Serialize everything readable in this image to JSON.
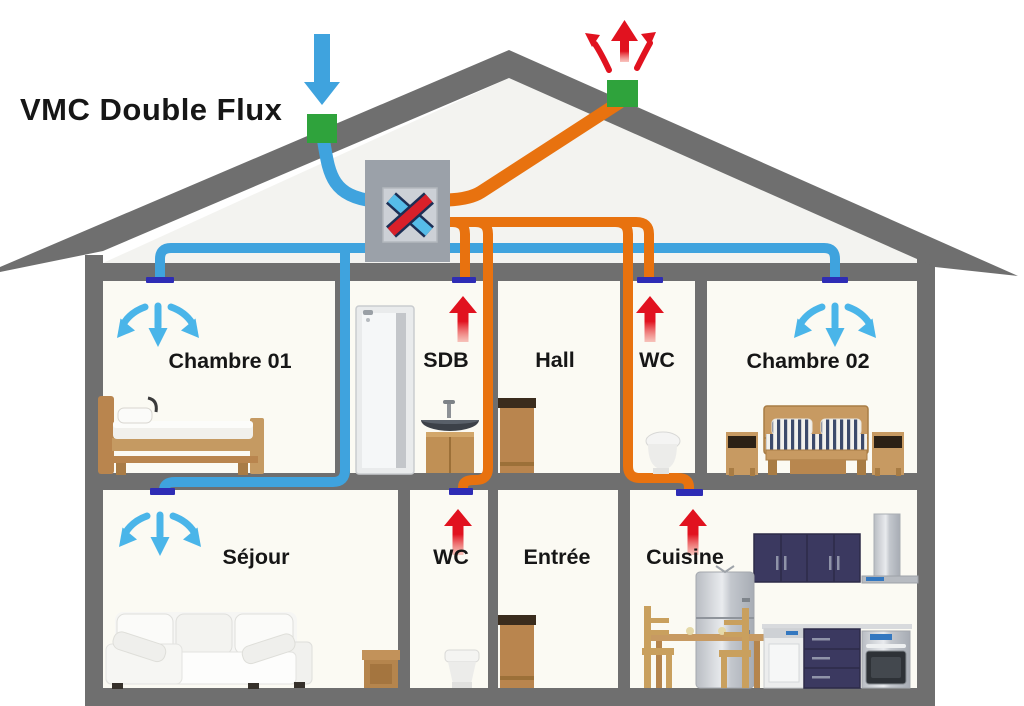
{
  "title": "VMC Double Flux",
  "rooms": {
    "upper": [
      {
        "label": "Chambre 01",
        "air": "supply"
      },
      {
        "label": "SDB",
        "air": "extract"
      },
      {
        "label": "Hall",
        "air": "none"
      },
      {
        "label": "WC",
        "air": "extract"
      },
      {
        "label": "Chambre 02",
        "air": "supply"
      }
    ],
    "lower": [
      {
        "label": "Séjour",
        "air": "supply"
      },
      {
        "label": "WC",
        "air": "extract"
      },
      {
        "label": "Entrée",
        "air": "none"
      },
      {
        "label": "Cuisine",
        "air": "extract"
      }
    ]
  },
  "symbols": {
    "fresh_air_intake_arrow": "↓",
    "exhaust_air_arrows": "↖↑↗",
    "supply_diffusion_arrows": "↙↓↘",
    "extract_arrow": "↑",
    "heat_exchanger_cross": "✕"
  },
  "colors": {
    "fresh_air_duct": "#3fa3de",
    "extract_air_duct": "#e8720f",
    "exhaust_arrow_red": "#e1121f",
    "supply_arrow_blue": "#4ab5e9",
    "roof_vent_green": "#2fa33c",
    "ceiling_diffuser_indigo": "#2e2cb5",
    "structure_gray": "#6f6f6f",
    "heat_exchanger_box": "#9ba1a9",
    "heat_exchanger_cross_red": "#d8202a",
    "heat_exchanger_cross_blue": "#56bce8"
  }
}
